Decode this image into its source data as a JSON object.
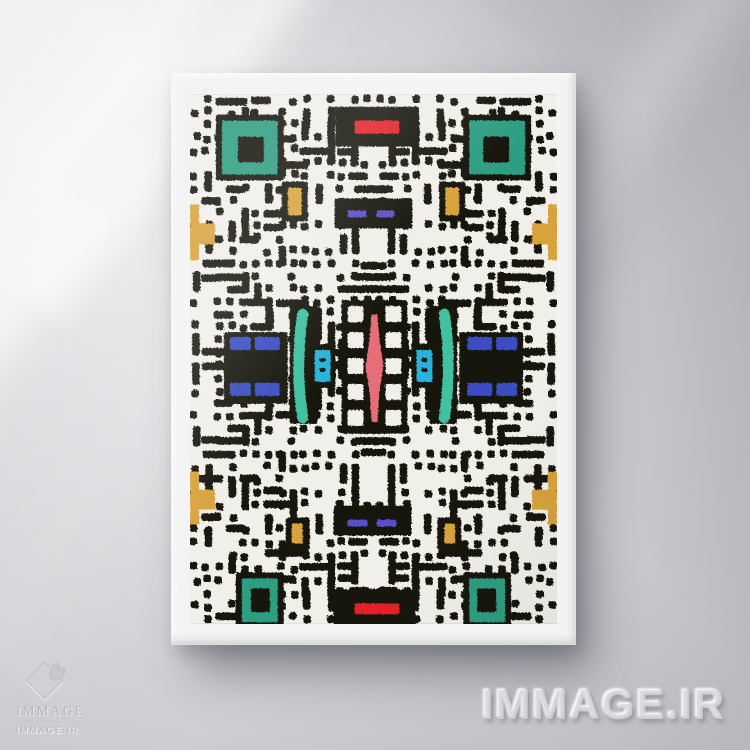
{
  "scene": {
    "kind": "framed abstract maze-pattern art print mockup on a sunlit wall"
  },
  "watermark": {
    "text": "IMMAGE.IR"
  },
  "logo": {
    "title": "IMMAGE",
    "site": "IMMAGE.IR"
  },
  "artwork": {
    "width": 368,
    "height": 530,
    "palette": {
      "ink": "#18130f",
      "paper": "#f1efea",
      "teal": "#2f9e82",
      "tealBar": "#3fc1a0",
      "cyan": "#29b3da",
      "blue": "#3a4ec1",
      "purple": "#5a50c8",
      "red": "#e2242b",
      "pink": "#e56e78",
      "mustard": "#d8a23e"
    },
    "maze": {
      "seed": 20,
      "cols": 15,
      "rows": 21,
      "density": 0.62,
      "thickness": 7.6,
      "gap": 4.6
    },
    "shapes": [
      {
        "c": "ink",
        "r": [
          146,
          12,
          82,
          40
        ]
      },
      {
        "c": "ink",
        "r": [
          26,
          20,
          68,
          66
        ]
      },
      {
        "c": "ink",
        "r": [
          274,
          20,
          68,
          66
        ]
      },
      {
        "c": "ink",
        "r": [
          92,
          87,
          26,
          40
        ]
      },
      {
        "c": "ink",
        "r": [
          250,
          87,
          26,
          40
        ]
      },
      {
        "c": "ink",
        "r": [
          145,
          104,
          78,
          30
        ]
      },
      {
        "c": "ink",
        "r": [
          34,
          238,
          64,
          72
        ]
      },
      {
        "c": "ink",
        "r": [
          270,
          238,
          64,
          72
        ]
      },
      {
        "c": "ink",
        "r": [
          100,
          212,
          28,
          118
        ]
      },
      {
        "c": "ink",
        "r": [
          240,
          212,
          28,
          118
        ]
      },
      {
        "c": "ink",
        "r": [
          120,
          250,
          26,
          44
        ]
      },
      {
        "c": "ink",
        "r": [
          222,
          250,
          26,
          44
        ]
      },
      {
        "c": "ink",
        "r": [
          152,
          206,
          66,
          134
        ]
      },
      {
        "c": "ink",
        "r": [
          144,
          412,
          78,
          30
        ]
      },
      {
        "c": "ink",
        "r": [
          96,
          424,
          24,
          32
        ]
      },
      {
        "c": "ink",
        "r": [
          248,
          424,
          24,
          32
        ]
      },
      {
        "c": "ink",
        "r": [
          144,
          496,
          82,
          38
        ]
      },
      {
        "c": "ink",
        "r": [
          46,
          479,
          48,
          56
        ]
      },
      {
        "c": "ink",
        "r": [
          274,
          479,
          48,
          56
        ]
      },
      {
        "c": "paper",
        "r": [
          158,
          212,
          16,
          16
        ]
      },
      {
        "c": "paper",
        "r": [
          196,
          212,
          16,
          16
        ]
      },
      {
        "c": "paper",
        "r": [
          158,
          238,
          16,
          16
        ]
      },
      {
        "c": "paper",
        "r": [
          196,
          238,
          16,
          16
        ]
      },
      {
        "c": "paper",
        "r": [
          158,
          264,
          16,
          16
        ]
      },
      {
        "c": "paper",
        "r": [
          196,
          264,
          16,
          16
        ]
      },
      {
        "c": "paper",
        "r": [
          158,
          290,
          16,
          16
        ]
      },
      {
        "c": "paper",
        "r": [
          196,
          290,
          16,
          16
        ]
      },
      {
        "c": "paper",
        "r": [
          158,
          316,
          16,
          16
        ]
      },
      {
        "c": "paper",
        "r": [
          196,
          316,
          16,
          16
        ]
      },
      {
        "c": "teal",
        "r": [
          32,
          26,
          56,
          54
        ]
      },
      {
        "c": "ink",
        "r": [
          48,
          42,
          26,
          26
        ]
      },
      {
        "c": "teal",
        "r": [
          280,
          26,
          56,
          54
        ]
      },
      {
        "c": "ink",
        "r": [
          294,
          42,
          26,
          26
        ]
      },
      {
        "c": "teal",
        "r": [
          52,
          485,
          36,
          44
        ]
      },
      {
        "c": "ink",
        "r": [
          61,
          495,
          19,
          24
        ]
      },
      {
        "c": "teal",
        "r": [
          280,
          485,
          36,
          44
        ]
      },
      {
        "c": "ink",
        "r": [
          288,
          495,
          19,
          24
        ]
      },
      {
        "c": "red",
        "r": [
          165,
          26,
          45,
          13
        ]
      },
      {
        "c": "red",
        "r": [
          165,
          510,
          45,
          11
        ]
      },
      {
        "c": "purple",
        "r": [
          158,
          116,
          19,
          7
        ]
      },
      {
        "c": "purple",
        "r": [
          187,
          116,
          18,
          7
        ]
      },
      {
        "c": "purple",
        "r": [
          158,
          426,
          20,
          7
        ]
      },
      {
        "c": "purple",
        "r": [
          187,
          426,
          20,
          7
        ]
      },
      {
        "c": "mustard",
        "r": [
          98,
          93,
          14,
          28
        ]
      },
      {
        "c": "mustard",
        "r": [
          256,
          93,
          14,
          28
        ]
      },
      {
        "c": "mustard",
        "r": [
          102,
          430,
          11,
          20
        ]
      },
      {
        "c": "mustard",
        "r": [
          255,
          430,
          11,
          20
        ]
      },
      {
        "c": "mustard",
        "pts": "0,110 9,110 9,129 25,129 25,150 9,150 9,166 0,166"
      },
      {
        "c": "mustard",
        "pts": "368,110 359,110 359,129 343,129 343,150 359,150 359,166 368,166"
      },
      {
        "c": "mustard",
        "pts": "0,378 9,378 9,396 25,396 25,416 9,416 9,431 0,431"
      },
      {
        "c": "mustard",
        "pts": "368,378 359,378 359,396 343,396 343,416 359,416 359,431 368,431"
      },
      {
        "c": "blue",
        "r": [
          40,
          243,
          21,
          13
        ]
      },
      {
        "c": "blue",
        "r": [
          65,
          243,
          25,
          13
        ]
      },
      {
        "c": "blue",
        "r": [
          40,
          289,
          21,
          13
        ]
      },
      {
        "c": "blue",
        "r": [
          65,
          289,
          25,
          13
        ]
      },
      {
        "c": "blue",
        "r": [
          307,
          243,
          21,
          13
        ]
      },
      {
        "c": "blue",
        "r": [
          278,
          243,
          25,
          13
        ]
      },
      {
        "c": "blue",
        "r": [
          307,
          289,
          21,
          13
        ]
      },
      {
        "c": "blue",
        "r": [
          278,
          289,
          25,
          13
        ]
      },
      {
        "c": "tealBar",
        "d": "M113,220 Q105,272 113,324",
        "sw": 11
      },
      {
        "c": "tealBar",
        "d": "M255,220 Q263,272 255,324",
        "sw": 11
      },
      {
        "c": "cyan",
        "r": [
          125,
          256,
          16,
          32
        ]
      },
      {
        "c": "cyan",
        "r": [
          227,
          256,
          16,
          32
        ]
      },
      {
        "c": "ink",
        "r": [
          130,
          264,
          6,
          4
        ]
      },
      {
        "c": "ink",
        "r": [
          130,
          274,
          6,
          4
        ]
      },
      {
        "c": "ink",
        "r": [
          232,
          264,
          6,
          4
        ]
      },
      {
        "c": "ink",
        "r": [
          232,
          274,
          6,
          4
        ]
      },
      {
        "c": "pink",
        "pts": "182,220 188,220 190,246 194,272 190,298 188,328 182,328 180,298 176,272 180,246"
      }
    ]
  }
}
